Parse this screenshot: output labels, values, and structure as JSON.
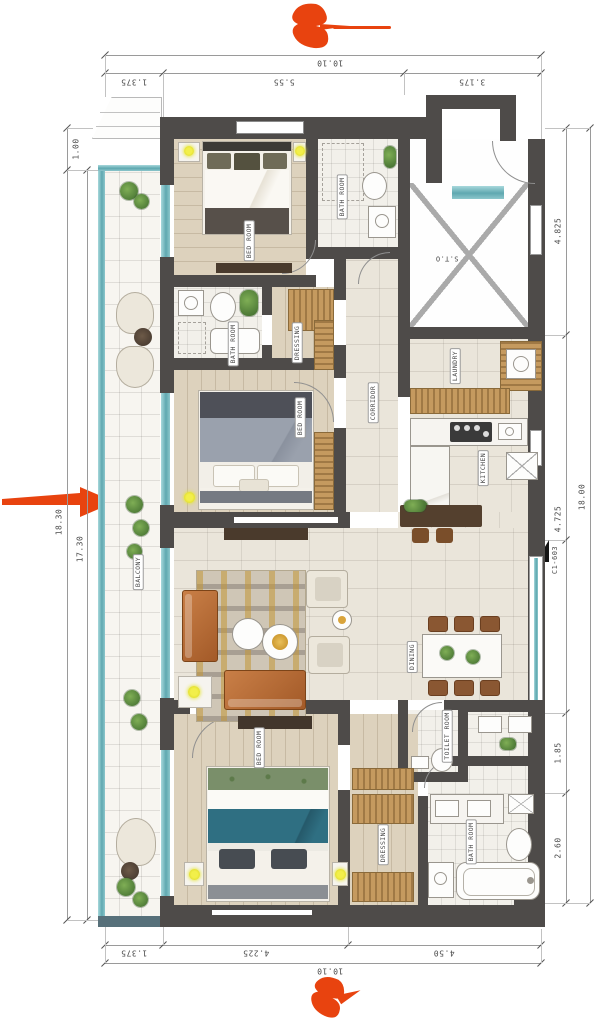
{
  "plan": {
    "unit_code": "C1-603",
    "type": "apartment-floor-plan"
  },
  "rooms": {
    "bed1": "BED ROOM",
    "bath1": "BATH ROOM",
    "sto": "S.T.O",
    "dress1": "DRESSING",
    "bath2": "BATH ROOM",
    "bed2": "BED ROOM",
    "corridor": "CORRIDOR",
    "laundry": "LAUNDRY",
    "kitchen": "KITCHEN",
    "balcony": "BALCONY",
    "dining": "DINING",
    "toilet": "TOILET ROOM",
    "bed3": "BED ROOM",
    "dress2": "DRESSING",
    "bath3": "BATH ROOM"
  },
  "dimensions": {
    "top": {
      "overall": "10.10",
      "segments": [
        "1.375",
        "5.55",
        "3.175"
      ]
    },
    "bottom": {
      "overall": "10.10",
      "segments": [
        "1.375",
        "4.225",
        "4.50"
      ]
    },
    "left": {
      "segments": [
        "1.00",
        "18.30",
        "17.30"
      ]
    },
    "right": {
      "overall": "18.00",
      "segments": [
        "4.825",
        "4.725",
        "1.85",
        "2.60"
      ]
    }
  },
  "colors": {
    "wall": "#4e4b49",
    "accent_red": "#e8430f",
    "glass_teal": "#5fa8b0",
    "wood": "#c59a5f",
    "lamp_yellow": "#e8e337"
  }
}
